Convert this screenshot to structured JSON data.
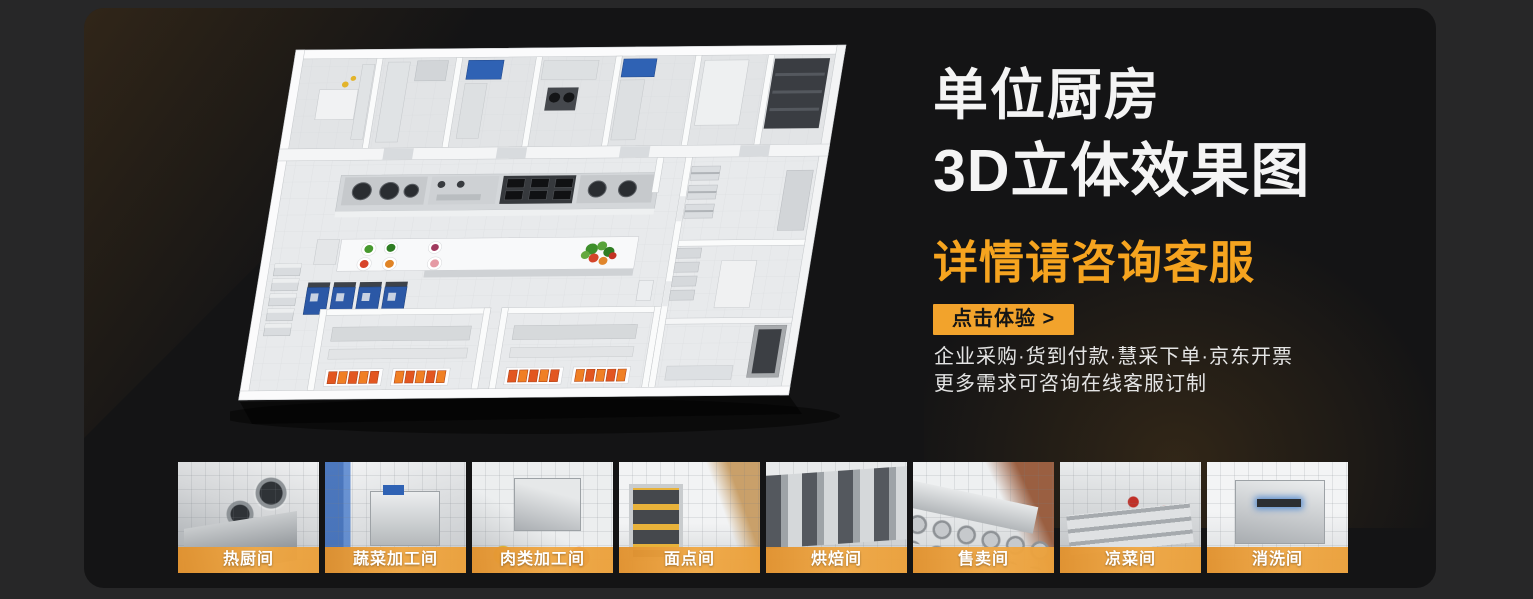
{
  "banner": {
    "title_line1": "单位厨房",
    "title_line2": "3D立体效果图",
    "subtitle": "详情请咨询客服",
    "cta_label": "点击体验 >",
    "desc_line1": "企业采购·货到付款·慧采下单·京东开票",
    "desc_line2": "更多需求可咨询在线客服订制"
  },
  "colors": {
    "accent_orange": "#F6A41F",
    "cta_background": "#F2A32C",
    "label_bar_orange": "#EDA23B",
    "panel_background": "#141415",
    "page_background": "#272728"
  },
  "icons": {
    "floorplan_image": "kitchen-3d-floorplan"
  },
  "thumbnails": [
    {
      "label": "热厨间"
    },
    {
      "label": "蔬菜加工间"
    },
    {
      "label": "肉类加工间"
    },
    {
      "label": "面点间"
    },
    {
      "label": "烘焙间"
    },
    {
      "label": "售卖间"
    },
    {
      "label": "凉菜间"
    },
    {
      "label": "消洗间"
    }
  ]
}
